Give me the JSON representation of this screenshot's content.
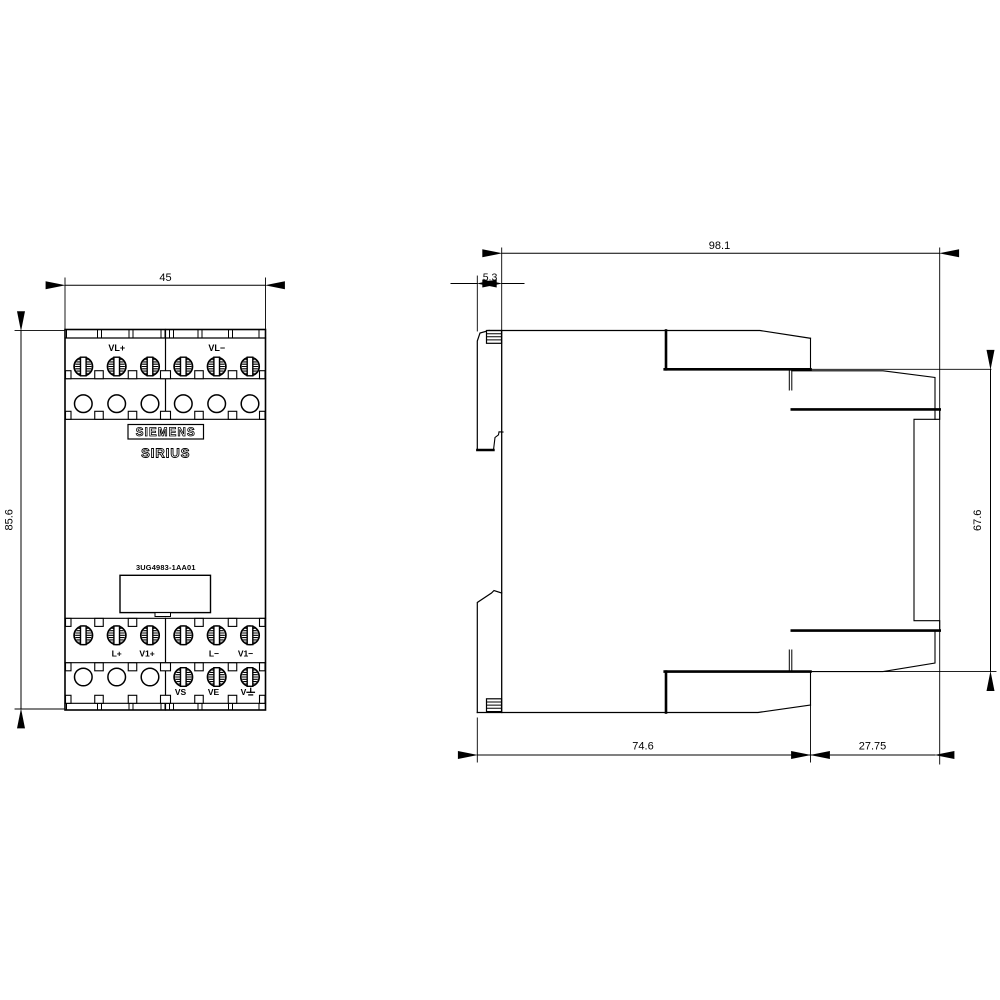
{
  "drawing": {
    "type": "dimensional-drawing",
    "colors": {
      "line": "#000000",
      "background": "#ffffff"
    },
    "brand": "SIEMENS",
    "product_line": "SIRIUS",
    "part_number": "3UG4983-1AA01",
    "front_view": {
      "dim_width": "45",
      "dim_height": "85.6",
      "terminal_labels_top": [
        "VL+",
        "VL−"
      ],
      "terminal_labels_mid": [
        "L+",
        "V1+",
        "L−",
        "V1−"
      ],
      "terminal_labels_bottom": [
        "VS",
        "VE",
        "V"
      ]
    },
    "side_view": {
      "dim_depth_total": "98.1",
      "dim_clip_depth": "5.3",
      "dim_terminal_span": "67.6",
      "dim_body_depth": "74.6",
      "dim_terminal_block_depth": "27.75"
    }
  }
}
